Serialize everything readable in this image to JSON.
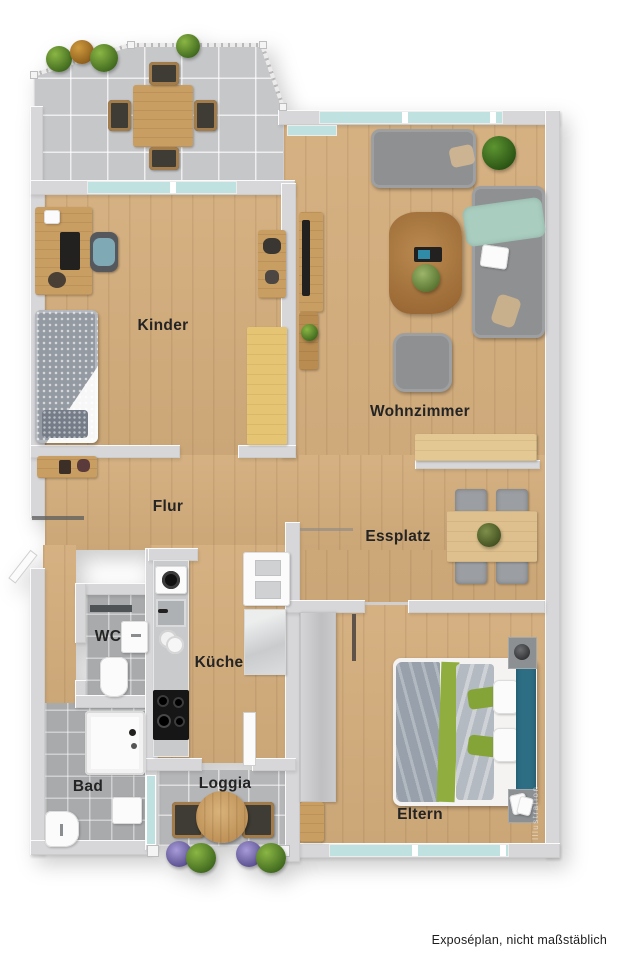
{
  "palette": {
    "wood": "#d3ad7c",
    "wall": "#d7d7d9",
    "glass": "#bfe2e1",
    "tile-light": "#c6c7c9",
    "tile-mid": "#b5b6b8",
    "tile-dark": "#a8aaac",
    "sofa": "#8e9092",
    "teal": "#2d6e85",
    "green": "#7ba338",
    "mint": "#a9cec0"
  },
  "rooms": {
    "kinder": "Kinder",
    "wohnzimmer": "Wohnzimmer",
    "flur": "Flur",
    "essplatz": "Essplatz",
    "wc": "WC",
    "kueche": "Küche",
    "bad": "Bad",
    "loggia": "Loggia",
    "eltern": "Eltern"
  },
  "footer": {
    "caption": "Exposéplan, nicht maßstäblich"
  },
  "watermark": {
    "text": "Illustration"
  }
}
